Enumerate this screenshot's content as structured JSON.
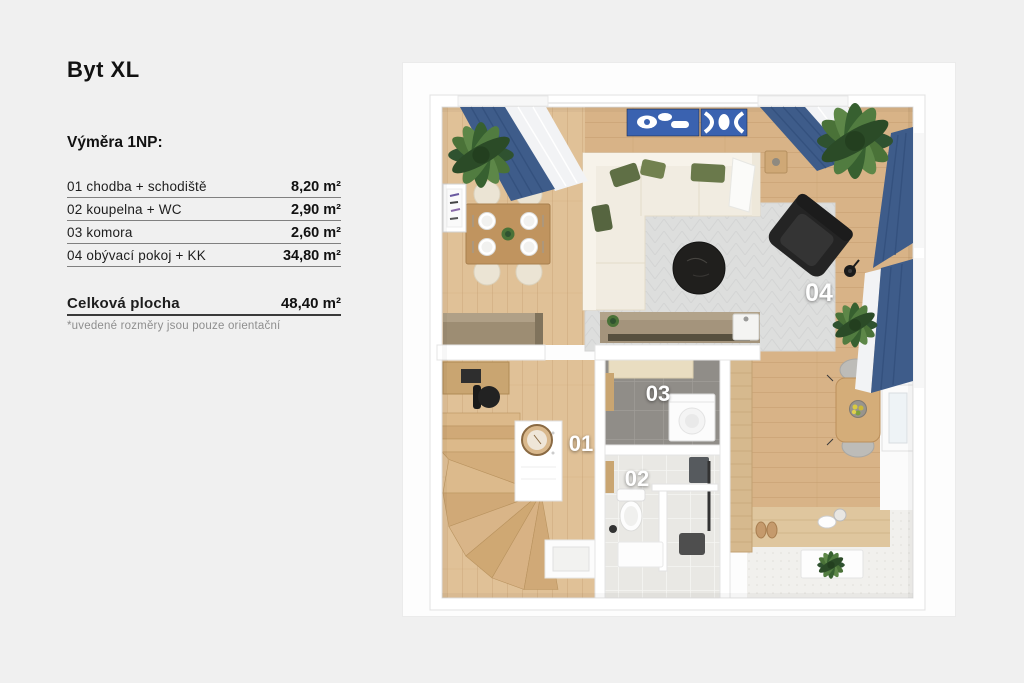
{
  "page": {
    "background_color": "#f0f0f0"
  },
  "legend": {
    "title": "Byt XL",
    "section_label": "Výměra 1NP:",
    "rows": [
      {
        "label": "01 chodba + schodiště",
        "value": "8,20 m²"
      },
      {
        "label": "02 koupelna + WC",
        "value": "2,90 m²"
      },
      {
        "label": "03 komora",
        "value": "2,60 m²"
      },
      {
        "label": "04 obývací pokoj + KK",
        "value": "34,80 m²"
      }
    ],
    "total": {
      "label": "Celková plocha",
      "value": "48,40 m²"
    },
    "note": "*uvedené rozměry jsou pouze orientační"
  },
  "floorplan": {
    "room_labels": [
      "01",
      "02",
      "03",
      "04"
    ],
    "colors": {
      "wood_floor": "#d8b387",
      "hall_floor": "#e0c197",
      "curtain_blue": "#3e5c8a",
      "wall_art_blue": "#3a62b0",
      "sofa_cream": "#f1ece1",
      "pillow_green": "#5c6b42",
      "rug_gray": "#dcdddd",
      "pantry_tile_gray": "#8f8c87",
      "bath_tile_light": "#e9e8e4",
      "counter_taupe": "#9c8c72",
      "room_label": "#ffffff"
    }
  }
}
